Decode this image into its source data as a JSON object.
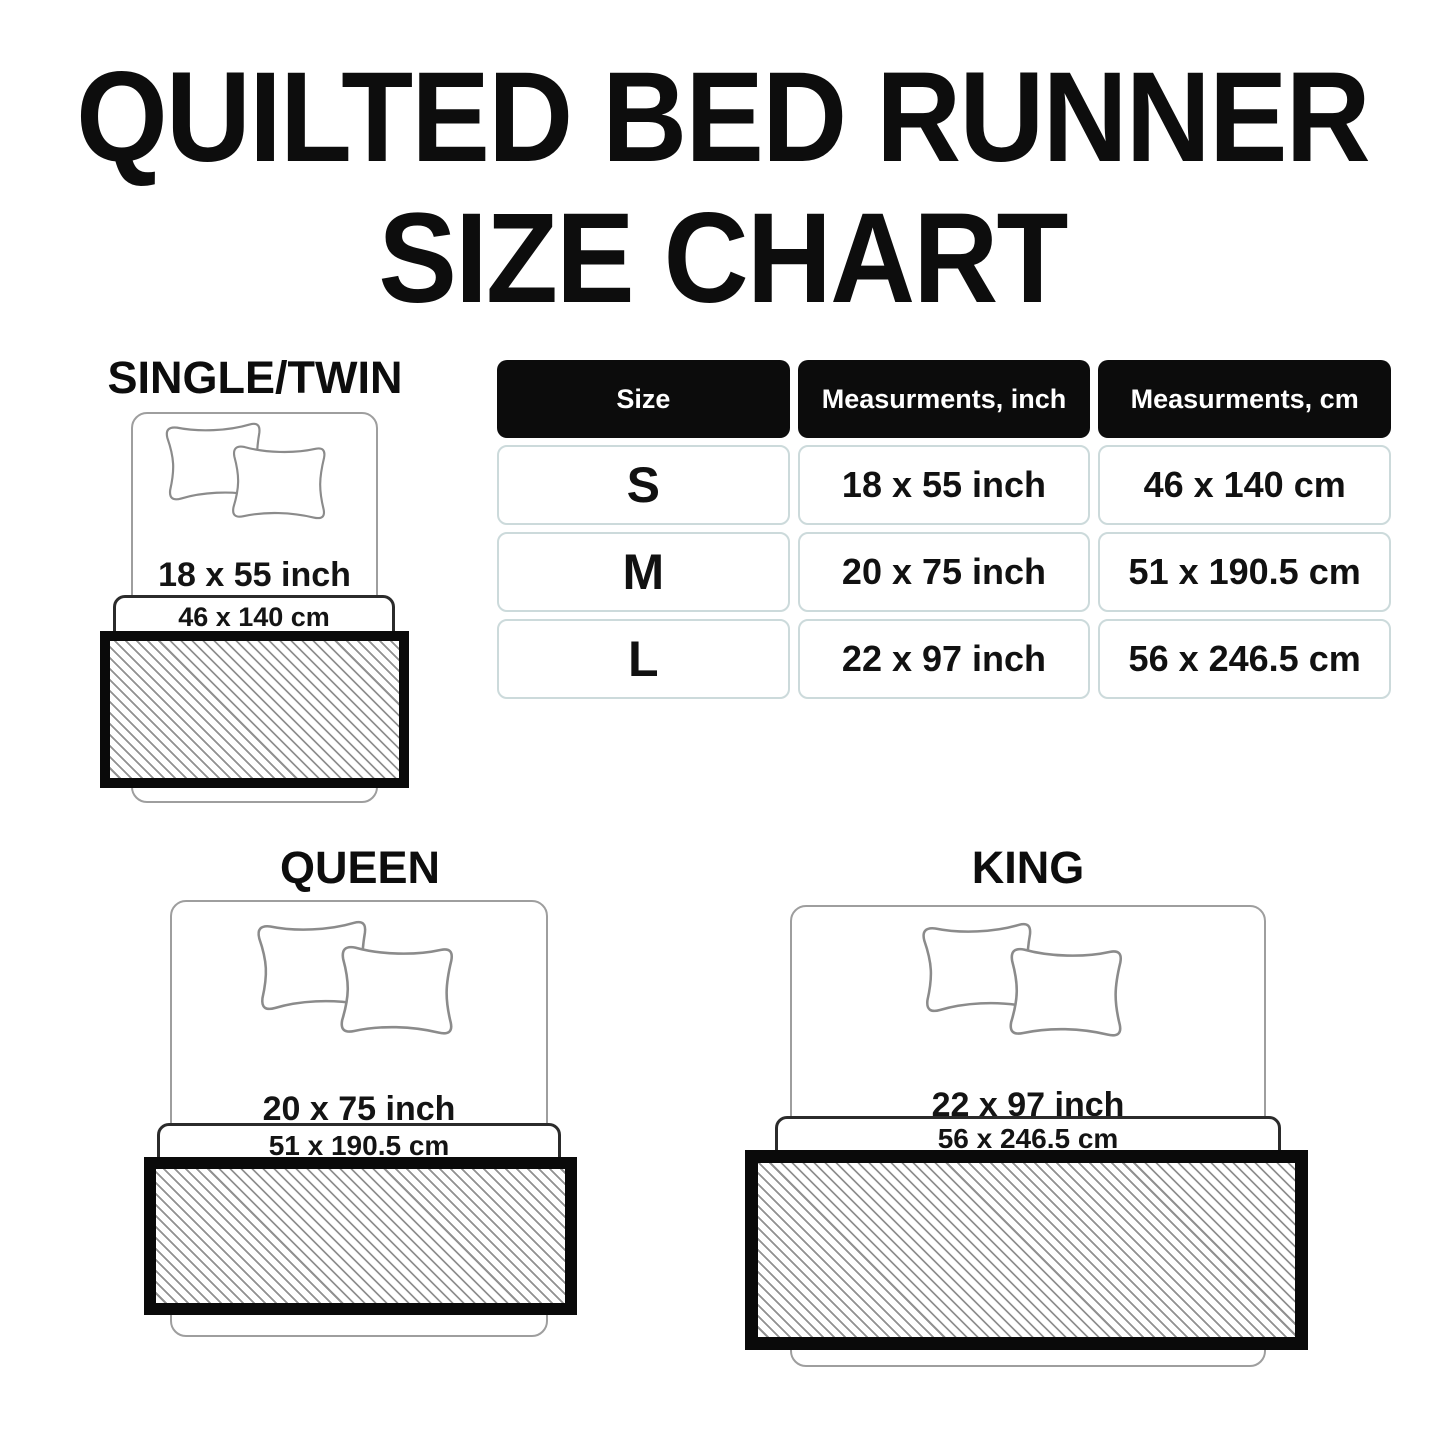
{
  "title": {
    "line1": "QUILTED BED RUNNER",
    "line2": "SIZE CHART"
  },
  "table": {
    "headers": {
      "size": "Size",
      "inch": "Measurments, inch",
      "cm": "Measurments, cm"
    },
    "rows": [
      {
        "size": "S",
        "inch": "18 x 55 inch",
        "cm": "46 x 140 cm"
      },
      {
        "size": "M",
        "inch": "20 x 75 inch",
        "cm": "51 x 190.5 cm"
      },
      {
        "size": "L",
        "inch": "22 x 97 inch",
        "cm": "56 x 246.5 cm"
      }
    ]
  },
  "diagrams": {
    "single": {
      "label": "SINGLE/TWIN",
      "inch": "18 x 55 inch",
      "cm": "46 x 140 cm"
    },
    "queen": {
      "label": "QUEEN",
      "inch": "20 x 75 inch",
      "cm": "51 x 190.5 cm"
    },
    "king": {
      "label": "KING",
      "inch": "22 x 97 inch",
      "cm": "56 x 246.5 cm"
    }
  },
  "colors": {
    "background": "#ffffff",
    "text": "#0d0d0d",
    "table_header_bg": "#0c0c0c",
    "table_header_text": "#ffffff",
    "table_cell_border": "#ccdadb",
    "bed_outline": "#9e9e9e",
    "pillow_outline": "#8b8b8b",
    "band_border": "#2b2b2b",
    "runner_border": "#0a0a0a",
    "hatch_line": "#919191"
  }
}
